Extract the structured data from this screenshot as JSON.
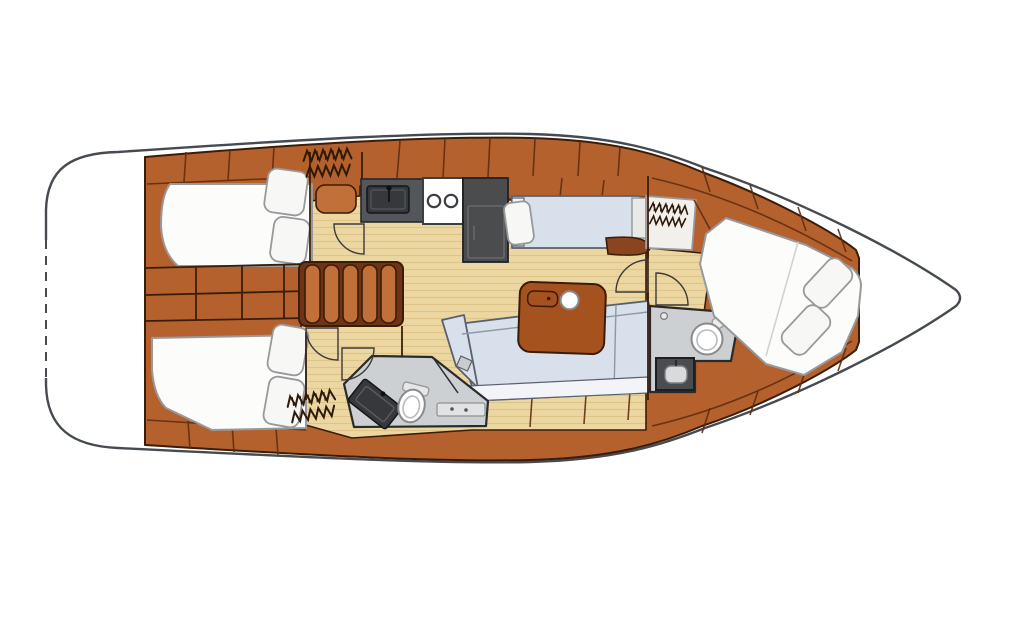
{
  "meta": {
    "title": "Sailboat interior layout floor plan, bow to the right",
    "type": "yacht-interior-floor-plan",
    "orientation": "bow-right"
  },
  "colors": {
    "background": "#ffffff",
    "hull_outline": "#454b51",
    "wood": "#b4612e",
    "wood_dark": "#8a4420",
    "wood_outline": "#3a1d09",
    "wood_seam": "#5f2d11",
    "floor": "#ecd7a2",
    "floor_line": "#dfc489",
    "mattress": "#fcfcfb",
    "mattress_outline": "#98999b",
    "pillow": "#f7f7f5",
    "upholstery": "#d7e0eb",
    "upholstery_outline": "#59616e",
    "upholstery_front": "#f2f4f7",
    "head_floor": "#cdd0d2",
    "head_outline": "#2a2a2a",
    "counter_dark": "#53565a",
    "appliance_dark": "#4a4c4e",
    "sink_dark": "#36383b",
    "fixture_white": "#ffffff",
    "fixture_outline": "#8a8a8a",
    "table_wood": "#a5521f",
    "stair_tread": "#c1703a",
    "stair_base": "#6e3414",
    "door_arc": "#3a3a3a",
    "hatch_mark": "#2f1a08"
  },
  "features": [
    {
      "id": "stern-swim-platform",
      "label": "stern transom with dashed opening swim platform"
    },
    {
      "id": "aft-cabin-port",
      "label": "aft double berth cabin, port"
    },
    {
      "id": "aft-cabin-starboard",
      "label": "aft double berth cabin, starboard"
    },
    {
      "id": "midship-lockers",
      "label": "locker bank between aft cabins"
    },
    {
      "id": "companionway-steps",
      "label": "companionway steps"
    },
    {
      "id": "galley",
      "label": "galley with sink, two-burner stove and refrigerator"
    },
    {
      "id": "nav-settee",
      "label": "starboard settee berth beside galley"
    },
    {
      "id": "salon",
      "label": "salon with L-shaped sofa and table"
    },
    {
      "id": "head-aft",
      "label": "aft head with shower, vanity sink and toilet"
    },
    {
      "id": "head-forward",
      "label": "forward head with sink and toilet"
    },
    {
      "id": "forward-cabin",
      "label": "forward cabin with angled island double berth"
    },
    {
      "id": "hanging-lockers",
      "label": "hanging lockers drawn with hanger hatch marks"
    },
    {
      "id": "bow",
      "label": "bow compartment"
    }
  ]
}
